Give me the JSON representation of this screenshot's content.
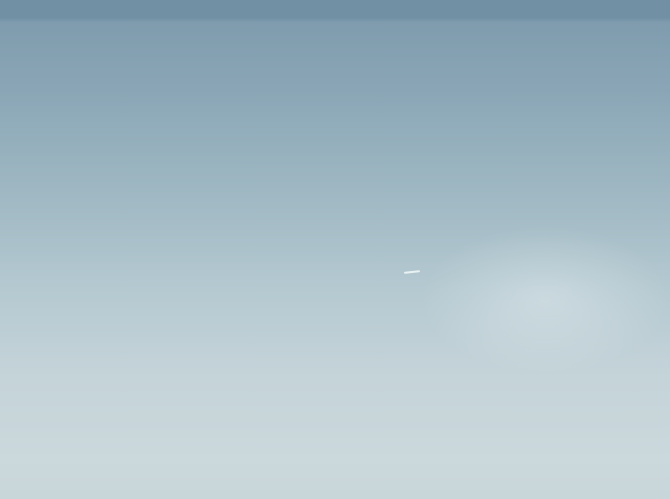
{
  "meta": {
    "description": "architectural elevation rendering, two residential towers with retail podium, palm trees"
  },
  "scene": {
    "size": {
      "w": 670,
      "h": 499
    },
    "colors": {
      "slab": "#f1f1f1",
      "pier": "#e3e3e3",
      "spandrel": "#0c0c0c",
      "winGlass": "#7e98a3",
      "winMull": "rgba(18,32,40,0.8)",
      "rail": "#1d2a31",
      "railLine": "#c9d3d7",
      "wingBg": "#10161a",
      "wingGlass": "#8ba6b1",
      "coreBg": "#070707",
      "coreWin": "#44545c",
      "beige": "#e8c7a6",
      "beigeLight": "#eccfb0",
      "black": "#0a0a0a",
      "cyan": "#aadce3",
      "smallWin": "#2c3840",
      "podiumTan": "#a3895f",
      "darkBand": "#14171a",
      "white": "#ebebeb",
      "storefront": "#39444a",
      "louverBg": "#16120e",
      "louverSlat": "#8a6845",
      "midTan": "#9c8a6a",
      "midWin": "#28323c",
      "brown": "#8b7758",
      "ext": "#968261",
      "groundTop": "#4e5b57",
      "groundBot": "#3f4b48",
      "groundLine": "#2b3633",
      "shadow": "#0b100e",
      "palm": "#6f8455",
      "palmDark": "#5b6f45",
      "trunk": "#7b7f64"
    },
    "sky": {
      "stops": [
        [
          "#7190a3",
          0
        ],
        [
          "#7190a3",
          3.5
        ],
        [
          "#7f9cae",
          4.5
        ],
        [
          "#8aa6b6",
          18
        ],
        [
          "#9eb7c2",
          38
        ],
        [
          "#b5c9d1",
          58
        ],
        [
          "#c5d4d9",
          76
        ],
        [
          "#cbd8dc",
          92
        ],
        [
          "#c8d5d9",
          100
        ]
      ],
      "cloud": {
        "n": "cloud-patch",
        "x": 420,
        "y": 225,
        "w": 250,
        "h": 150,
        "bg": "radial-gradient(ellipse at center, rgba(240,246,247,0.35), rgba(240,246,247,0) 70%)"
      }
    },
    "marks": [
      {
        "n": "airplane-contrail",
        "x": 404,
        "y": 271,
        "w": 16,
        "h": 2,
        "bg": "#f4f8f9",
        "br": "2px",
        "rot": -6,
        "op": 0.85
      },
      {
        "n": "bird",
        "x": 448,
        "y": 347,
        "w": 9,
        "h": 1.6,
        "bg": "#49555b",
        "br": "2px",
        "rot": -5,
        "op": 0.9
      }
    ],
    "right_tower_rects": [
      {
        "n": "right-tower-facade",
        "x": 518,
        "y": 45,
        "w": 92,
        "h": 358,
        "bg": "#e8c7a6",
        "pats": [
          [
            "v",
            6,
            "rgba(203,150,114,0.4)"
          ],
          [
            "h",
            4,
            "rgba(214,170,136,0.3)"
          ]
        ]
      },
      {
        "n": "right-tower-parapet",
        "x": 586,
        "y": 21,
        "w": 24,
        "h": 382,
        "bg": "#eccfb0",
        "pats": [
          [
            "v",
            6,
            "rgba(205,155,118,0.35)"
          ],
          [
            "h",
            4,
            "rgba(216,175,140,0.3)"
          ]
        ]
      },
      {
        "n": "right-tower-parapet-edge",
        "x": 586,
        "y": 21,
        "w": 2,
        "h": 382,
        "bg": "rgba(150,100,70,0.35)"
      },
      {
        "n": "right-tower-right-edge",
        "x": 607.5,
        "y": 45,
        "w": 2.5,
        "h": 358,
        "bg": "rgba(140,95,65,0.3)"
      },
      {
        "n": "right-tower-black-core",
        "x": 492,
        "y": 50,
        "w": 28,
        "h": 353,
        "bg": "#0a0a0a"
      },
      {
        "n": "right-tower-black-wing",
        "x": 472,
        "y": 166,
        "w": 20,
        "h": 237,
        "bg": "#0d0d0d"
      },
      {
        "n": "right-tower-roof-black",
        "x": 499,
        "y": 27,
        "w": 21,
        "h": 25,
        "bg": "#0b0b0b"
      },
      {
        "n": "roof-pergola-frame",
        "x": 508,
        "y": 24,
        "w": 48,
        "h": 21,
        "frame": "3px solid #f3f3f3"
      },
      {
        "n": "roof-glass-railing",
        "x": 518,
        "y": 43,
        "w": 74,
        "h": 9,
        "bg": "#aadce3",
        "pats": [
          [
            "v",
            5,
            "rgba(70,120,130,0.5)"
          ]
        ],
        "bt": "1px solid #f0f5f5"
      }
    ],
    "right_tower_floors": {
      "n": 15,
      "y0": 52,
      "fh": 23.4,
      "slab": {
        "x": 505,
        "w": 73,
        "h": 3
      },
      "pier": {
        "x": 557,
        "w": 4
      },
      "wins": [
        {
          "x": 524,
          "w": 9,
          "dy": 4,
          "h": 10
        },
        {
          "x": 547,
          "w": 9,
          "dy": 5,
          "h": 9
        },
        {
          "x": 563,
          "w": 10,
          "dy": 5,
          "h": 9
        }
      ],
      "colWin": {
        "x": 596,
        "w": 9,
        "dy": 4,
        "h": 11
      }
    },
    "left_top_rects": [
      {
        "n": "left-tower-roof-slab",
        "x": 30,
        "y": 29,
        "w": 249,
        "h": 4,
        "bg": "#f3f3f3"
      },
      {
        "n": "left-tower-top-floor",
        "x": 30,
        "y": 33,
        "w": 249,
        "h": 23,
        "bg": "#141414"
      },
      {
        "n": "top-corner-glass-left",
        "x": 33,
        "y": 37,
        "w": 57,
        "h": 18,
        "bg": "#76949e",
        "pats": [
          [
            "v",
            5,
            "rgba(25,45,52,0.7)"
          ]
        ]
      },
      {
        "n": "top-corner-glass-right",
        "x": 218,
        "y": 37,
        "w": 58,
        "h": 18,
        "bg": "#76949e",
        "pats": [
          [
            "v",
            5,
            "rgba(25,45,52,0.7)"
          ]
        ]
      },
      {
        "n": "penthouse-wall",
        "x": 148,
        "y": 33,
        "w": 70,
        "h": 9,
        "bg": "#e2c1a1"
      },
      {
        "n": "roof-terrace-railing",
        "x": 94,
        "y": 40,
        "w": 122,
        "h": 16,
        "bg": "#9dc0c6",
        "pats": [
          [
            "v",
            5,
            "rgba(55,95,105,0.45)"
          ]
        ],
        "bt": "1px solid #eef2f3"
      },
      {
        "n": "penthouse",
        "x": 148,
        "y": 15,
        "w": 70,
        "h": 18,
        "bg": "linear-gradient(180deg,#f0dcc6,#d7a985)"
      },
      {
        "n": "antenna-dot",
        "x": 188,
        "y": 20,
        "w": 3,
        "h": 3,
        "bg": "#222222",
        "br": "50%"
      }
    ],
    "left_tower_floors": {
      "x": 30,
      "n": 15,
      "y0": 56,
      "fh": 22.93,
      "bays": [
        {
          "t": "wing",
          "x": 0,
          "w": 33
        },
        {
          "t": "pier",
          "x": 33,
          "w": 3
        },
        {
          "t": "win",
          "x": 36,
          "w": 26
        },
        {
          "t": "pier",
          "x": 62,
          "w": 3
        },
        {
          "t": "win",
          "x": 65,
          "w": 26
        },
        {
          "t": "pier",
          "x": 91,
          "w": 3
        },
        {
          "t": "win",
          "x": 94,
          "w": 26
        },
        {
          "t": "pier",
          "x": 120,
          "w": 3
        },
        {
          "t": "core",
          "x": 123,
          "w": 33
        },
        {
          "t": "pier",
          "x": 156,
          "w": 3
        },
        {
          "t": "win",
          "x": 159,
          "w": 26
        },
        {
          "t": "pier",
          "x": 185,
          "w": 3
        },
        {
          "t": "win",
          "x": 188,
          "w": 26
        },
        {
          "t": "pier",
          "x": 214,
          "w": 3
        },
        {
          "t": "wing",
          "x": 217,
          "w": 32
        }
      ]
    },
    "left_edge_rects": [
      {
        "n": "left-tower-right-pier",
        "x": 274.5,
        "y": 33,
        "w": 3.5,
        "h": 367,
        "bg": "#e9e9e9"
      },
      {
        "n": "left-tower-left-edge",
        "x": 30,
        "y": 33,
        "w": 1.5,
        "h": 367,
        "bg": "rgba(230,235,236,0.8)"
      }
    ],
    "mid_rects": [
      {
        "n": "tower-base-white-box",
        "x": 256,
        "y": 384,
        "w": 23,
        "h": 14,
        "bg": "#ededed"
      },
      {
        "n": "background-trees",
        "x": -6,
        "y": 396,
        "w": 24,
        "h": 72,
        "bg": "#c3cacb",
        "br": "40%"
      },
      {
        "n": "background-trees",
        "x": 386,
        "y": 414,
        "w": 42,
        "h": 22,
        "bg": "#b9c1c0",
        "br": "50%",
        "op": 0.85
      },
      {
        "n": "background-trees",
        "x": 384,
        "y": 420,
        "w": 30,
        "h": 48,
        "bg": "#96a09e",
        "br": "45%"
      },
      {
        "n": "background-trees",
        "x": 403,
        "y": 427,
        "w": 27,
        "h": 42,
        "bg": "#8d9896",
        "br": "45%"
      },
      {
        "n": "background-trees",
        "x": 415,
        "y": 437,
        "w": 23,
        "h": 32,
        "bg": "#a0aaa8",
        "br": "45%"
      },
      {
        "n": "background-trees",
        "x": 610,
        "y": 407,
        "w": 36,
        "h": 62,
        "bg": "#9aa5a2",
        "br": "45%"
      },
      {
        "n": "background-trees",
        "x": 631,
        "y": 419,
        "w": 31,
        "h": 50,
        "bg": "#929d9b",
        "br": "45%"
      },
      {
        "n": "background-trees",
        "x": 649,
        "y": 413,
        "w": 23,
        "h": 56,
        "bg": "#a2adaa",
        "br": "45%"
      },
      {
        "n": "left-podium-parapet",
        "x": 14,
        "y": 396,
        "w": 252,
        "h": 13,
        "bg": "#14171a"
      },
      {
        "n": "left-podium-slab",
        "x": 14,
        "y": 409,
        "w": 252,
        "h": 3,
        "bg": "#e6e6e6"
      },
      {
        "n": "left-podium-wall",
        "x": 14,
        "y": 412,
        "w": 252,
        "h": 56,
        "bg": "#a3895f",
        "pats": [
          [
            "h",
            8,
            "rgba(60,42,20,0.15)"
          ]
        ]
      },
      {
        "n": "podium-upper-window",
        "x": 38,
        "y": 416,
        "w": 50,
        "h": 24,
        "bg": "#333c41",
        "pats": [
          [
            "h",
            6,
            "rgba(130,140,148,0.7)"
          ],
          [
            "v",
            12,
            "rgba(130,140,148,0.5)"
          ]
        ]
      },
      {
        "n": "podium-upper-window",
        "x": 93,
        "y": 416,
        "w": 50,
        "h": 24,
        "bg": "#333c41",
        "pats": [
          [
            "h",
            6,
            "rgba(130,140,148,0.7)"
          ],
          [
            "v",
            12,
            "rgba(130,140,148,0.5)"
          ]
        ]
      },
      {
        "n": "podium-upper-window",
        "x": 253,
        "y": 416,
        "w": 13,
        "h": 24,
        "bg": "#333c41",
        "pats": [
          [
            "h",
            6,
            "rgba(130,140,148,0.7)"
          ]
        ]
      },
      {
        "n": "louver-panel-frame",
        "x": 145,
        "y": 402,
        "w": 108,
        "h": 38,
        "bg": "#f2f2f2"
      },
      {
        "n": "louver-panel",
        "x": 150,
        "y": 408,
        "w": 98,
        "h": 27,
        "bg": "#16120e",
        "pats": [
          [
            "slat",
            5,
            "#8a6845",
            2
          ]
        ]
      },
      {
        "n": "left-podium-band",
        "x": 14,
        "y": 440,
        "w": 252,
        "h": 2,
        "bg": "#6b5b41"
      },
      {
        "n": "storefront-window",
        "x": 38,
        "y": 442,
        "w": 48,
        "h": 24,
        "bg": "#39444a",
        "pats": [
          [
            "v",
            12,
            "rgba(13,21,25,0.8)"
          ],
          [
            "h",
            13,
            "rgba(13,21,25,0.5)"
          ]
        ]
      },
      {
        "n": "storefront-window",
        "x": 91,
        "y": 442,
        "w": 48,
        "h": 24,
        "bg": "#39444a",
        "pats": [
          [
            "v",
            12,
            "rgba(13,21,25,0.8)"
          ],
          [
            "h",
            13,
            "rgba(13,21,25,0.5)"
          ]
        ]
      },
      {
        "n": "storefront-window",
        "x": 144,
        "y": 442,
        "w": 48,
        "h": 24,
        "bg": "#39444a",
        "pats": [
          [
            "v",
            12,
            "rgba(13,21,25,0.8)"
          ],
          [
            "h",
            13,
            "rgba(13,21,25,0.5)"
          ]
        ]
      },
      {
        "n": "storefront-window",
        "x": 197,
        "y": 442,
        "w": 48,
        "h": 24,
        "bg": "#39444a",
        "pats": [
          [
            "v",
            12,
            "rgba(13,21,25,0.8)"
          ],
          [
            "h",
            13,
            "rgba(13,21,25,0.5)"
          ]
        ]
      },
      {
        "n": "mid-building-roof-block",
        "x": 318,
        "y": 381,
        "w": 34,
        "h": 13,
        "bg": "#14171a"
      },
      {
        "n": "mid-building-parapet",
        "x": 266,
        "y": 393,
        "w": 124,
        "h": 10,
        "bg": "#e9e9e9"
      },
      {
        "n": "mid-building-clerestory",
        "x": 274,
        "y": 383,
        "w": 62,
        "h": 12,
        "bg": "#efefef"
      },
      {
        "n": "clerestory-window",
        "x": 280,
        "y": 385,
        "w": 6,
        "h": 8,
        "bg": "#1c2429",
        "rep": {
          "num": 6,
          "dx": 9.5
        }
      },
      {
        "n": "mid-building-left-pier",
        "x": 266,
        "y": 393,
        "w": 8,
        "h": 74,
        "bg": "#e2e2e2"
      },
      {
        "n": "mid-building-wall",
        "x": 274,
        "y": 403,
        "w": 114,
        "h": 64,
        "bg": "#9c8a6a"
      },
      {
        "n": "mid-building-window",
        "x": 283,
        "y": 406,
        "w": 48,
        "h": 31,
        "bg": "#28323c",
        "pats": [
          [
            "v",
            12,
            "rgba(110,130,142,0.5)"
          ],
          [
            "h",
            16,
            "rgba(140,152,158,0.55)"
          ]
        ]
      },
      {
        "n": "mid-building-window",
        "x": 336,
        "y": 406,
        "w": 48,
        "h": 31,
        "bg": "#28323c",
        "pats": [
          [
            "v",
            12,
            "rgba(110,130,142,0.5)"
          ],
          [
            "h",
            16,
            "rgba(140,152,158,0.55)"
          ]
        ]
      },
      {
        "n": "mid-building-band",
        "x": 274,
        "y": 437,
        "w": 114,
        "h": 3,
        "bg": "#8a795c"
      },
      {
        "n": "mid-building-window",
        "x": 283,
        "y": 440,
        "w": 48,
        "h": 26,
        "bg": "#28323c",
        "pats": [
          [
            "v",
            12,
            "rgba(110,130,142,0.5)"
          ],
          [
            "h",
            14,
            "rgba(140,152,158,0.55)"
          ]
        ]
      },
      {
        "n": "mid-building-window",
        "x": 336,
        "y": 440,
        "w": 48,
        "h": 26,
        "bg": "#28323c",
        "pats": [
          [
            "v",
            12,
            "rgba(110,130,142,0.5)"
          ],
          [
            "h",
            14,
            "rgba(140,152,158,0.55)"
          ]
        ]
      },
      {
        "n": "utility-box-roof",
        "x": 428,
        "y": 382,
        "w": 42,
        "h": 2,
        "bg": "#f5f5f5"
      },
      {
        "n": "white-utility-box",
        "x": 428,
        "y": 384,
        "w": 42,
        "h": 21,
        "bg": "#e8e8e6"
      },
      {
        "n": "utility-box-window",
        "x": 433,
        "y": 388,
        "w": 11,
        "h": 12,
        "bg": "#20282c"
      },
      {
        "n": "utility-box-window",
        "x": 449,
        "y": 388,
        "w": 12,
        "h": 12,
        "bg": "#20282c"
      },
      {
        "n": "dark-service-wall",
        "x": 428,
        "y": 405,
        "w": 24,
        "h": 62,
        "bg": "#19150f"
      },
      {
        "n": "service-ladder",
        "x": 408,
        "y": 442,
        "w": 8,
        "h": 22,
        "pats": [
          [
            "lad"
          ]
        ]
      },
      {
        "n": "right-podium-coping",
        "x": 452,
        "y": 401,
        "w": 161,
        "h": 3,
        "bg": "#cfc5ae"
      },
      {
        "n": "right-podium-wall",
        "x": 452,
        "y": 404,
        "w": 161,
        "h": 63,
        "bg": "#8b7758",
        "pats": [
          [
            "h",
            7,
            "rgba(35,24,12,0.2)"
          ]
        ]
      },
      {
        "n": "wall-joint",
        "x": 520,
        "y": 430,
        "w": 1.5,
        "h": 37,
        "bg": "rgba(40,30,15,0.4)"
      },
      {
        "n": "wall-joint",
        "x": 575,
        "y": 428,
        "w": 1.5,
        "h": 39,
        "bg": "rgba(40,30,15,0.4)"
      },
      {
        "n": "wall-joint",
        "x": 604,
        "y": 425,
        "w": 1.5,
        "h": 42,
        "bg": "rgba(40,30,15,0.4)"
      },
      {
        "n": "right-low-wall",
        "x": 613,
        "y": 452,
        "w": 57,
        "h": 16,
        "bg": "#968261",
        "pats": [
          [
            "h",
            6,
            "rgba(35,24,12,0.15)"
          ]
        ]
      }
    ],
    "ground": {
      "y": 466,
      "h": 33,
      "shadows": [
        [
          16,
          70
        ],
        [
          96,
          56
        ],
        [
          162,
          56
        ],
        [
          226,
          38
        ],
        [
          296,
          88
        ],
        [
          392,
          52
        ],
        [
          452,
          96
        ],
        [
          556,
          66
        ],
        [
          628,
          38
        ]
      ]
    },
    "palms": [
      {
        "cx": 6,
        "cy": 392,
        "s": 1.25,
        "layer": "back"
      },
      {
        "cx": 383,
        "cy": 382,
        "s": 1.25,
        "layer": "front"
      },
      {
        "cx": 433,
        "cy": 379,
        "s": 1.0,
        "layer": "front"
      },
      {
        "cx": 627,
        "cy": 388,
        "s": 0.95,
        "layer": "front"
      },
      {
        "cx": 656,
        "cy": 368,
        "s": 1.35,
        "layer": "front"
      }
    ],
    "trunks": [
      {
        "pts": "412.5,396 417.5,396 416,470 411,470"
      },
      {
        "pts": "649,382 655,382 653.5,473 647.5,473"
      }
    ]
  }
}
